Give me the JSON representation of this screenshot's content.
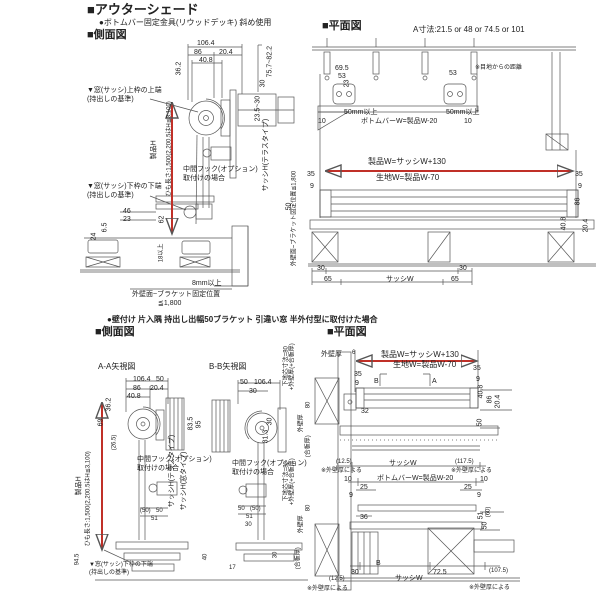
{
  "colors": {
    "arrow_red": "#c03028",
    "line_gray": "#555555"
  },
  "header": {
    "title": "■アウターシェード",
    "subtitle": "●ボトムバー固定金具(リウッドデッキ) 斜め使用"
  },
  "headings": {
    "side_view": "■側面図",
    "plan_view": "■平面図",
    "plan_note": "A寸法:21.5 or 48 or 74.5 or 101",
    "bottom_case": "●壁付け 片入隅 持出し出幅50ブラケット 引違い窓 半外付型に取付けた場合",
    "aa_view": "A-A矢視図",
    "bb_view": "B-B矢視図"
  },
  "formulas": {
    "product_w": "製品W=サッシW+130",
    "fabric_w": "生地W=製品W-70",
    "bottombar_w": "ボトムバーW=製品W-20",
    "product_h": "製品H",
    "cord_len": "ひも長さ:1,500(2,200.5はH≦3,100)",
    "sash_w": "サッシW",
    "sash_h_terrace": "サッシH(テラスタイプ)",
    "sash_h_window": "サッシH(窓タイプ)",
    "wall_bracket": "外壁面~ブラケット固定位置",
    "wall_bracket_max": "≦1,800",
    "wall_bracket_inline": "外壁面~ブラケット固定位置≦1,800",
    "base_core": "下地芯寸法=80",
    "base_core_add": "+外壁厚(+合板厚)",
    "wall_t": "外壁厚",
    "board_t": "(合板厚)",
    "by_wall": "※外壁厚による",
    "joint_dist": "※目地からの距離"
  },
  "notes": {
    "upper_edge": "▼窓(サッシ)上枠の上端",
    "lower_edge": "▼窓(サッシ)下枠の下端",
    "datum": "(持出しの基準)",
    "hook1": "中間フック(オプション)",
    "hook2": "取付けの場合",
    "sec_a": "A",
    "sec_b": "B"
  },
  "dims": {
    "w106_4": "106.4",
    "w86": "86",
    "w20_4": "20.4",
    "w40_8": "40.8",
    "w36_2": "36.2",
    "w75_7": "75.7~82.2",
    "w30": "30",
    "w23_5": "23.5~30",
    "w46": "46",
    "w23": "23",
    "w6_5": "6.5",
    "w24": "24",
    "w62": "62",
    "w18min": "18以上",
    "w8min": "8mm以上",
    "w50min": "50mm以上",
    "w69_5": "69.5",
    "w53": "53",
    "w10": "10",
    "w35": "35",
    "w9": "9",
    "w65": "65",
    "w50": "50",
    "w51": "51",
    "w25": "25",
    "w32": "32",
    "w36": "36",
    "w40": "40",
    "w17": "17",
    "w69": "69",
    "w94_5": "94.5",
    "w83_5": "83.5",
    "w95": "95",
    "w31_3": "31.3",
    "w26_5": "(26.5)",
    "w50p": "(50)",
    "w60p": "(60)",
    "w12_5p": "(12.5)",
    "w117_5p": "(117.5)",
    "w107_5p": "(107.5)",
    "w72_5": "72.5",
    "w80": "80",
    "w6": "6"
  }
}
